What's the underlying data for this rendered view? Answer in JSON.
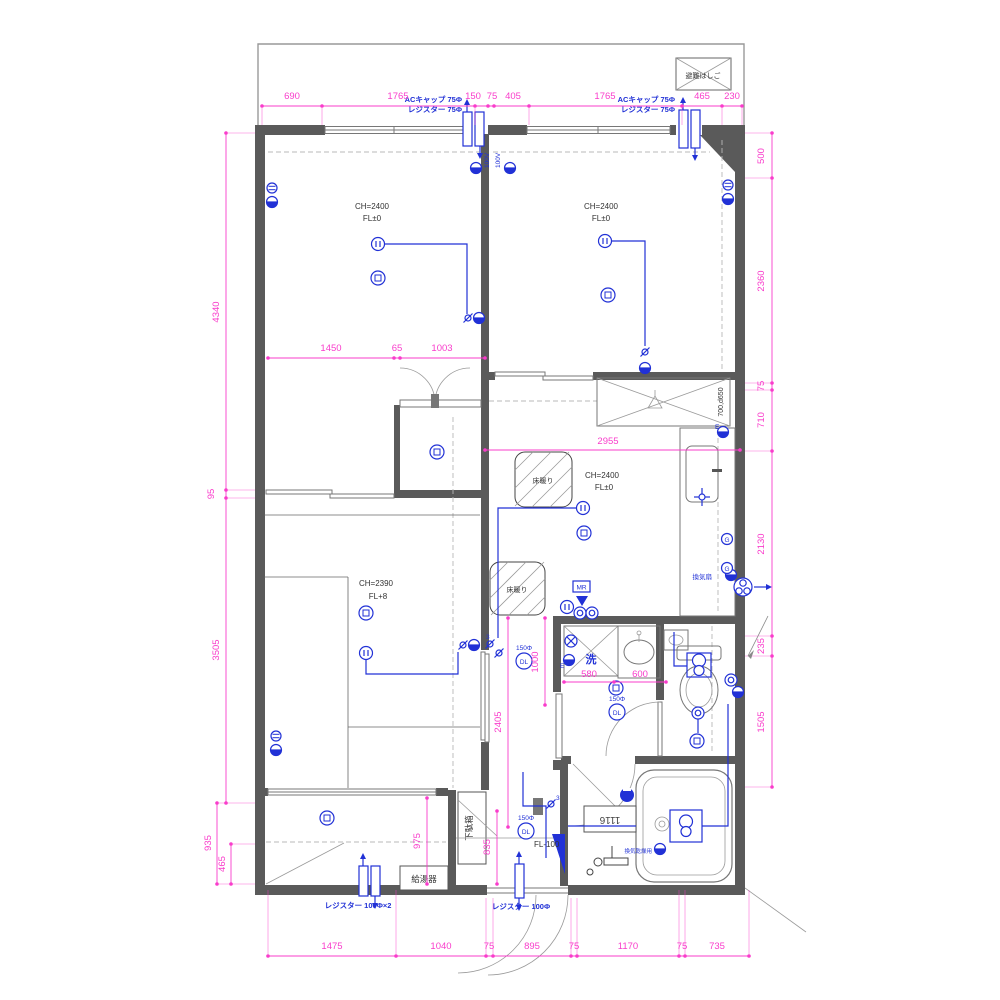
{
  "colors": {
    "dimension_pink": "#f93ccb",
    "electrical_blue": "#2131d6",
    "wall_gray": "#5a5a5a"
  },
  "labels": {
    "escape_hatch": "避難はしご",
    "ac_cap": "ACキャップ 75Φ",
    "register_75": "レジスター 75Φ",
    "register_100x2": "レジスター 100Φ×2",
    "register_100": "レジスター 100Φ",
    "water_heater": "給湯器",
    "shoe_cabinet": "下駄箱",
    "range_fan": "換気扇",
    "bath_dryer": "換気乾燥用",
    "washer_mark": "洗",
    "floor_heating": "床暖り",
    "tub_size": "1116",
    "fridge_size": "700,d650",
    "volt_100": "100V",
    "size_150": "150Φ",
    "downlight": "DL",
    "gas": "G",
    "earth": "E",
    "mr": "MR",
    "three_way": "3"
  },
  "rooms": {
    "bedroom_left": {
      "ch": "CH=2400",
      "fl": "FL±0"
    },
    "bedroom_right": {
      "ch": "CH=2400",
      "fl": "FL±0"
    },
    "ldk": {
      "ch": "CH=2400",
      "fl": "FL±0"
    },
    "japanese_room": {
      "ch": "CH=2390",
      "fl": "FL+8"
    },
    "entrance": {
      "fl": "FL-100"
    }
  },
  "dims": {
    "top": [
      "690",
      "1765",
      "150",
      "75",
      "405",
      "1765",
      "465",
      "230"
    ],
    "bottom": [
      "1475",
      "1040",
      "75",
      "895",
      "75",
      "1170",
      "75",
      "735"
    ],
    "left": [
      "4340",
      "95",
      "3505",
      "935",
      "465"
    ],
    "right": [
      "500",
      "2360",
      "75",
      "710",
      "2130",
      "235",
      "1505"
    ],
    "bedroom_left_width": [
      "1450",
      "65",
      "1003"
    ],
    "ldk_width": "2955",
    "washroom": [
      "580",
      "600"
    ],
    "porch_depth": "975",
    "entry_depth": "835",
    "corridor_depth": "2405",
    "hall_width": "1000"
  }
}
